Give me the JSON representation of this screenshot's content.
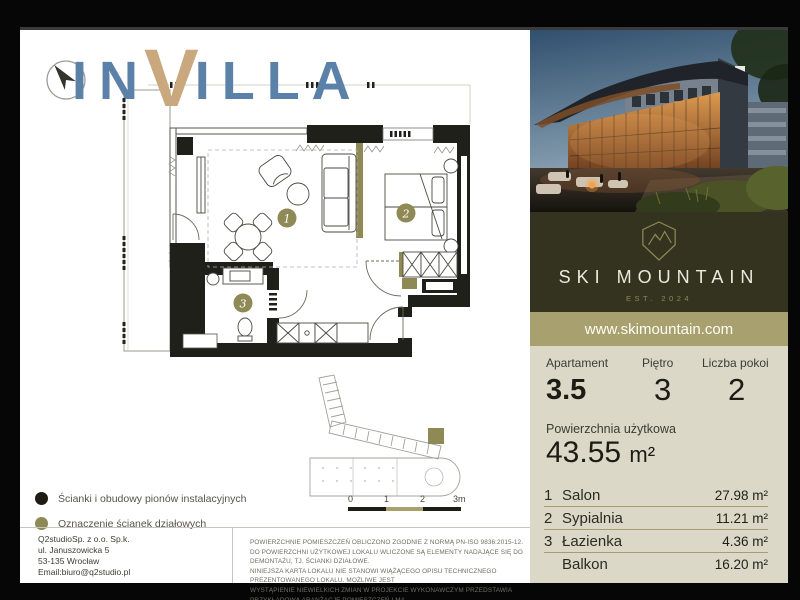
{
  "logo": {
    "part1": "IN",
    "accent": "V",
    "part2": "ILLA"
  },
  "legend": {
    "items": [
      {
        "label": "Ścianki i obudowy pionów instalacyjnych",
        "color": "#1d1d16"
      },
      {
        "label": "Oznaczenie ścianek działowych",
        "color": "#8f8a55"
      }
    ]
  },
  "floor_plan": {
    "badges": [
      "1",
      "2",
      "3"
    ]
  },
  "scale_bar": {
    "labels": [
      "0",
      "1",
      "2",
      "3m"
    ]
  },
  "company": {
    "lines": [
      "Q2studioSp. z o.o. Sp.k.",
      "ul. Januszowicka 5",
      "53-135 Wrocław",
      "Email:biuro@q2studio.pl"
    ]
  },
  "disclaimer": {
    "lines": [
      "POWIERZCHNIE POMIESZCZEŃ OBLICZONO ZGODNIE Z NORMĄ PN-ISO 9836:2015-12.",
      "DO POWIERZCHNI UŻYTKOWEJ LOKALU WLICZONE SĄ ELEMENTY NADAJĄCE SIĘ DO DEMONTAŻU, TJ. ŚCIANKI DZIAŁOWE.",
      "NINIEJSZA KARTA LOKALU NIE STANOWI WIĄŻĄCEGO OPISU TECHNICZNEGO PREZENTOWANEGO LOKALU. MOŻLIWE JEST",
      "WYSTĄPIENIE NIEWIELKICH ZMIAN W PROJEKCIE WYKONAWCZYM PRZEDSTAWIA PRZYKŁADOWĄ ARANŻACJĘ POMIESZCZEŃ I MA",
      "CHARAKTER POGLĄDOWY ORAZ NIE STANOWI OFERTY W ROZUMIENIU ART. 66 §1 KODEKSU CYWILNEGO."
    ]
  },
  "resort": {
    "name": "SKI MOUNTAIN",
    "established": "EST. 2024",
    "website": "www.skimountain.com"
  },
  "details": {
    "apartment_label": "Apartament",
    "apartment_value": "3.5",
    "floor_label": "Piętro",
    "floor_value": "3",
    "rooms_label": "Liczba pokoi",
    "rooms_value": "2",
    "area_label": "Powierzchnia użytkowa",
    "area_value": "43.55",
    "area_unit": "m²"
  },
  "rooms": [
    {
      "no": "1",
      "name": "Salon",
      "area": "27.98 m²"
    },
    {
      "no": "2",
      "name": "Sypialnia",
      "area": "11.21 m²"
    },
    {
      "no": "3",
      "name": "Łazienka",
      "area": "4.36 m²"
    },
    {
      "no": "",
      "name": "Balkon",
      "area": "16.20 m²"
    }
  ],
  "colors": {
    "logo_blue": "#5b81a8",
    "logo_tan": "#c9a87e",
    "accent_olive": "#8f8a55",
    "bar_olive": "#a8a06e",
    "panel_beige": "#dbd8c7",
    "dark_block": "#33331f",
    "wall_black": "#20201a"
  }
}
